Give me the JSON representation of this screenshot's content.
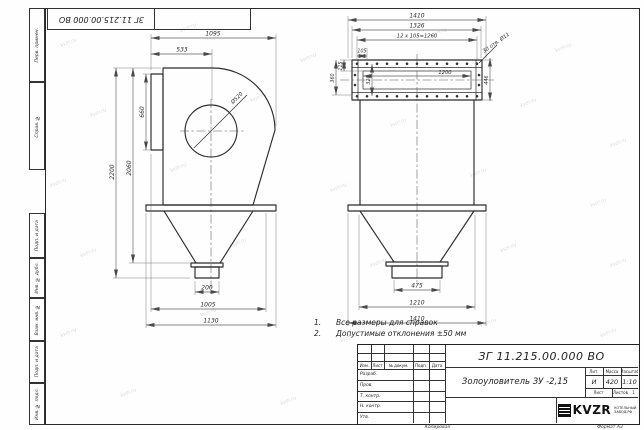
{
  "sheet": {
    "watermark_text": "kvzr.ru",
    "doc_number_top": "ЗГ 11.215.00.000 ВО",
    "copied_label": "Копировал",
    "format_label": "Формат А3"
  },
  "margin_stamps": {
    "top": [
      "Перв. примен.",
      "Справ. №"
    ],
    "bottom": [
      "Подп. и дата",
      "Инв. № дубл.",
      "Взам. инв. №",
      "Подп. и дата",
      "Инв. № подл."
    ]
  },
  "notes": [
    {
      "num": "1.",
      "text": "Все размеры для справок"
    },
    {
      "num": "2.",
      "text": "Допустимые отклонения  ±50 мм"
    }
  ],
  "front_view": {
    "dim_1095": "1095",
    "dim_533": "533",
    "dim_660": "660",
    "dim_2200": "2200",
    "dim_2060": "2060",
    "dia_520": "Ø520",
    "dim_200": "200",
    "dim_1005": "1005",
    "dim_1130": "1130"
  },
  "side_view": {
    "dim_1410_top": "1410",
    "dim_1326": "1326",
    "dim_pitch": "12 х 105=1260",
    "dim_105": "105",
    "holes_note": "30 отв. Ø11",
    "dim_1200": "1200",
    "dim_115": "115",
    "dim_360": "360",
    "dim_320": "320",
    "dim_446": "446",
    "dim_475": "475",
    "dim_1210": "1210",
    "dim_1410_bottom": "1410"
  },
  "title_block": {
    "doc_number": "ЗГ 11.215.00.000  ВО",
    "part_name": "Золоуловитель ЗУ -2,15",
    "header_cols": [
      "Изм.",
      "Лист",
      "№ докум.",
      "Подп.",
      "Дата"
    ],
    "role_rows": [
      "Разраб.",
      "Пров.",
      "Т. контр.",
      "Н. контр.",
      "Утв."
    ],
    "lit_header": "Лит.",
    "mass_header": "Масса",
    "scale_header": "Масштаб",
    "lit_value": "И",
    "mass_value": "420",
    "scale_value": "1:10",
    "sheet_label": "Лист",
    "sheets_label": "Листов",
    "sheets_value": "1",
    "logo_text": "KVZR",
    "company_line1": "КОТЕЛЬНЫЙ",
    "company_line2": "ЗАВОД.РФ"
  }
}
